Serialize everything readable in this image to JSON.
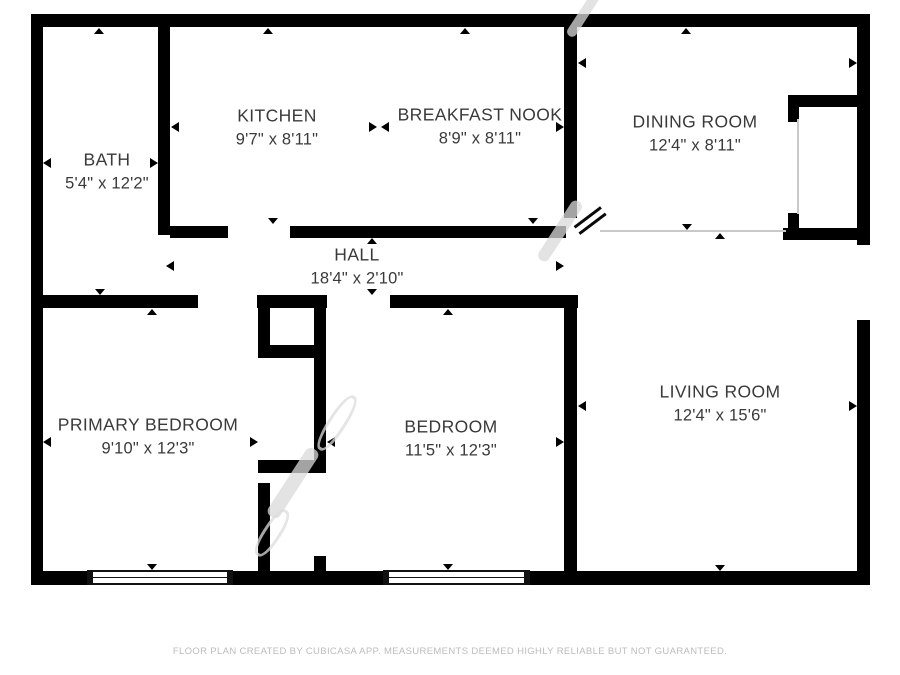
{
  "title": "Floor plan",
  "rooms": [
    {
      "name": "BATH",
      "dims": "5'4\" x 12'2\""
    },
    {
      "name": "KITCHEN",
      "dims": "9'7\" x 8'11\""
    },
    {
      "name": "BREAKFAST NOOK",
      "dims": "8'9\" x 8'11\""
    },
    {
      "name": "DINING ROOM",
      "dims": "12'4\" x 8'11\""
    },
    {
      "name": "HALL",
      "dims": "18'4\" x 2'10\""
    },
    {
      "name": "PRIMARY BEDROOM",
      "dims": "9'10\" x 12'3\""
    },
    {
      "name": "BEDROOM",
      "dims": "11'5\" x 12'3\""
    },
    {
      "name": "LIVING ROOM",
      "dims": "12'4\" x 15'6\""
    }
  ],
  "footer": {
    "disclaimer": "FLOOR PLAN CREATED BY CUBICASA APP. MEASUREMENTS DEEMED HIGHLY RELIABLE BUT NOT GUARANTEED."
  },
  "colors": {
    "wall": "#000000",
    "background": "#ffffff",
    "label_text": "#3a3a3a",
    "footer_text": "#bcbcbc",
    "thin_line": "#c9c9c9"
  }
}
